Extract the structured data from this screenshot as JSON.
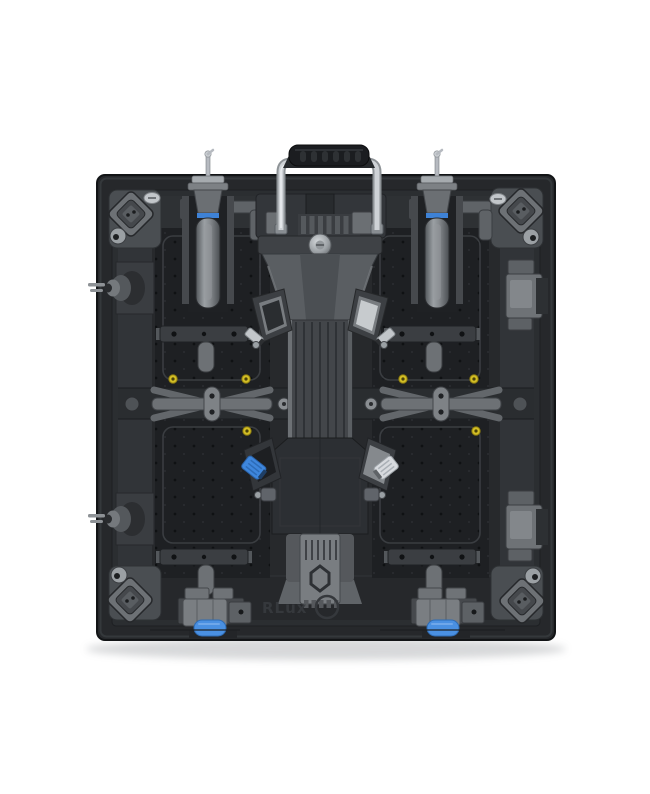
{
  "image": {
    "subject": "Rear view of a die-cast LED video wall panel cabinet",
    "background_color": "#ffffff"
  },
  "panel": {
    "embossed_logo": "RLux",
    "accent_colors": {
      "body_dark": "#26282b",
      "plate_dark": "#1e2023",
      "hardware_gray": "#75797d",
      "chrome_handle": "#ced2d6",
      "grip_black": "#1b1d20",
      "lock_ring_blue": "#3e82d6",
      "connector_blue": "#4a90e2",
      "connector_silver": "#d7dade",
      "screw_yellow": "#d3be25"
    },
    "component_names": [
      "carrying-handle",
      "lock-knob-left",
      "lock-knob-right",
      "corner-bracket-top-left",
      "corner-bracket-top-right",
      "corner-bracket-bottom-left",
      "corner-bracket-bottom-right",
      "edge-hub-upper-left",
      "edge-hub-lower-left",
      "latch-block-upper-right",
      "latch-block-lower-right",
      "cross-brace-left",
      "cross-brace-right",
      "power-module",
      "signal-connector-blue",
      "power-connector-silver",
      "bottom-lock-left",
      "bottom-lock-right"
    ]
  }
}
